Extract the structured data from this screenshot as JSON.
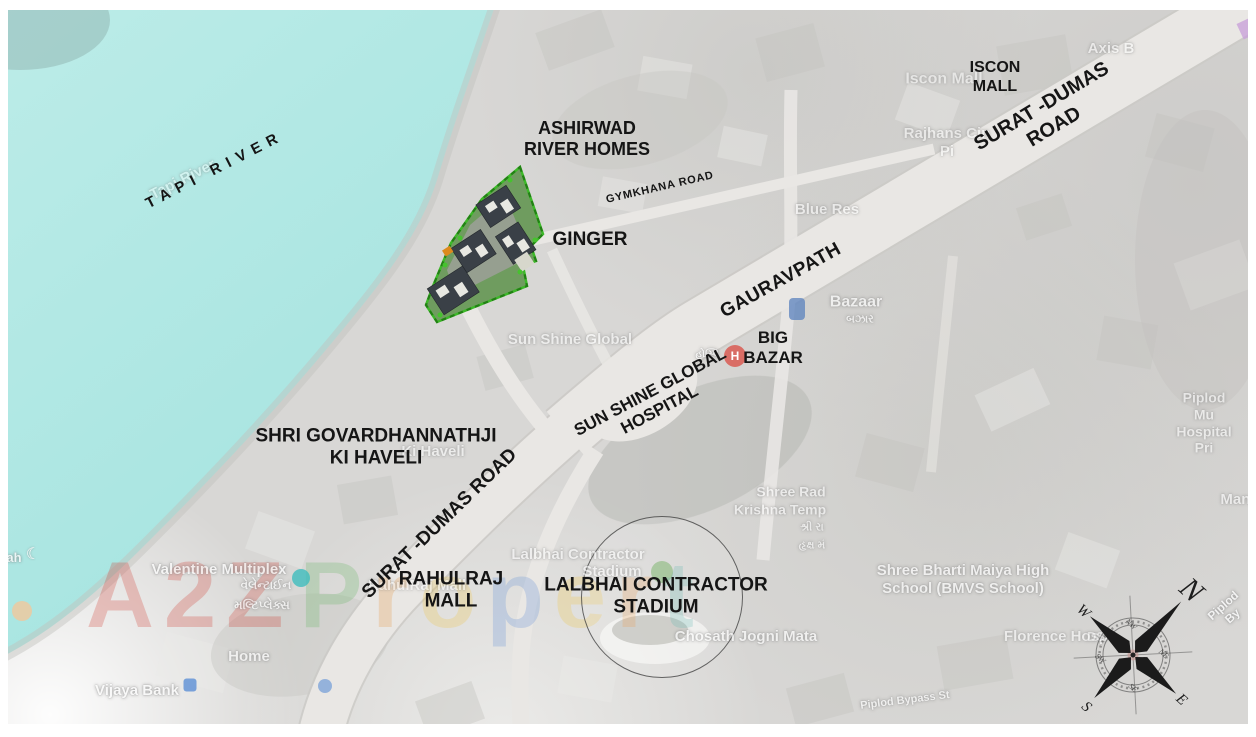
{
  "colors": {
    "river": "#abe6e2",
    "river_light": "#bcece8",
    "land": "#d8d7d5",
    "road_fill": "#e9e7e4",
    "road_edge": "#cbc9c5",
    "bold_label": "#151515",
    "bg_label": "#fbfbfb",
    "site_green_border": "#3db829",
    "site_green_dark": "#1f7a12",
    "building_gray": "#3a4047",
    "watermark_red": "#cf3a2f",
    "hospital_red": "#d95a52",
    "poi_blue": "#5a82be",
    "poi_teal": "#3fbdbd"
  },
  "labels": {
    "tapi_river": "TAPI RIVER",
    "ashirwad": "ASHIRWAD\nRIVER HOMES",
    "ginger": "GINGER",
    "iscon_mall": "ISCON\nMALL",
    "big_bazar": "BIG\nBAZAR",
    "sunshine_hospital": "SUN SHINE GLOBAL\nHOSPITAL",
    "haveli": "SHRI GOVARDHANNATHJI\nKI HAVELI",
    "rahulraj_mall": "RAHULRAJ\nMALL",
    "stadium": "LALBHAI CONTRACTOR\nSTADIUM"
  },
  "roads": {
    "surat_dumas_ne": "SURAT -DUMAS ROAD",
    "surat_dumas_sw": "SURAT -DUMAS ROAD",
    "gauravpath": "GAURAVPATH",
    "gymkhana_road": "GYMKHANA ROAD"
  },
  "bg": {
    "tapi_river": "Tapi River",
    "iscon_mall": "Iscon Mall",
    "axis": "Axis B",
    "rajhans": "Rajhans Cin\nPi",
    "blue_rest": "Blue Res",
    "bazaar": "Bazaar",
    "bazaar_gj": "બઝાર",
    "sunshine_global": "Sun Shine Global",
    "hospital_gj": "હોસ્પિ",
    "ki_haveli": "Ki Haveli",
    "valentine": "Valentine Multiplex",
    "valentine_gj1": "વેલેન્ટાઈન",
    "valentine_gj2": "મલ્ટિપ્લેક્સ",
    "home": "Home",
    "vijaya_bank": "Vijaya Bank",
    "ah": "ah",
    "rahulraj": "RahulRaj Mall",
    "lalbhai1": "Lalbhai Contractor",
    "lalbhai2": "Stadium",
    "chosath": "Chosath Jogni Mata",
    "shree_rad": "Shree Rad",
    "krishna": "Krishna Temp",
    "krishna_gj1": "શ્રી રા",
    "krishna_gj2": "હૃક્ષ મં",
    "bmvs": "Shree Bharti Maiya High\nSchool (BMVS School)",
    "florence": "Florence Hosp",
    "piplod_bypass": "Piplod Bypass St",
    "piplod_by": "Piplod By",
    "piplod_mu": "Piplod Mu\nHospital Pri",
    "mang": "Mang",
    "ds": "DS"
  },
  "markers": {
    "hospital_h": "H",
    "mosque_crescent": "☾"
  },
  "compass": {
    "n": "N",
    "e": "E",
    "s": "S",
    "w": "W",
    "nw": "NW",
    "ne": "NE",
    "se": "SE",
    "sw": "SW"
  },
  "watermark": {
    "part1": "A2Z",
    "part2": "Propert",
    "part2_colors": [
      "#4fae4d",
      "#e8892a",
      "#f0c02c",
      "#4a7fd4",
      "#f0c02c",
      "#e8892a",
      "#3fa8a0"
    ]
  }
}
